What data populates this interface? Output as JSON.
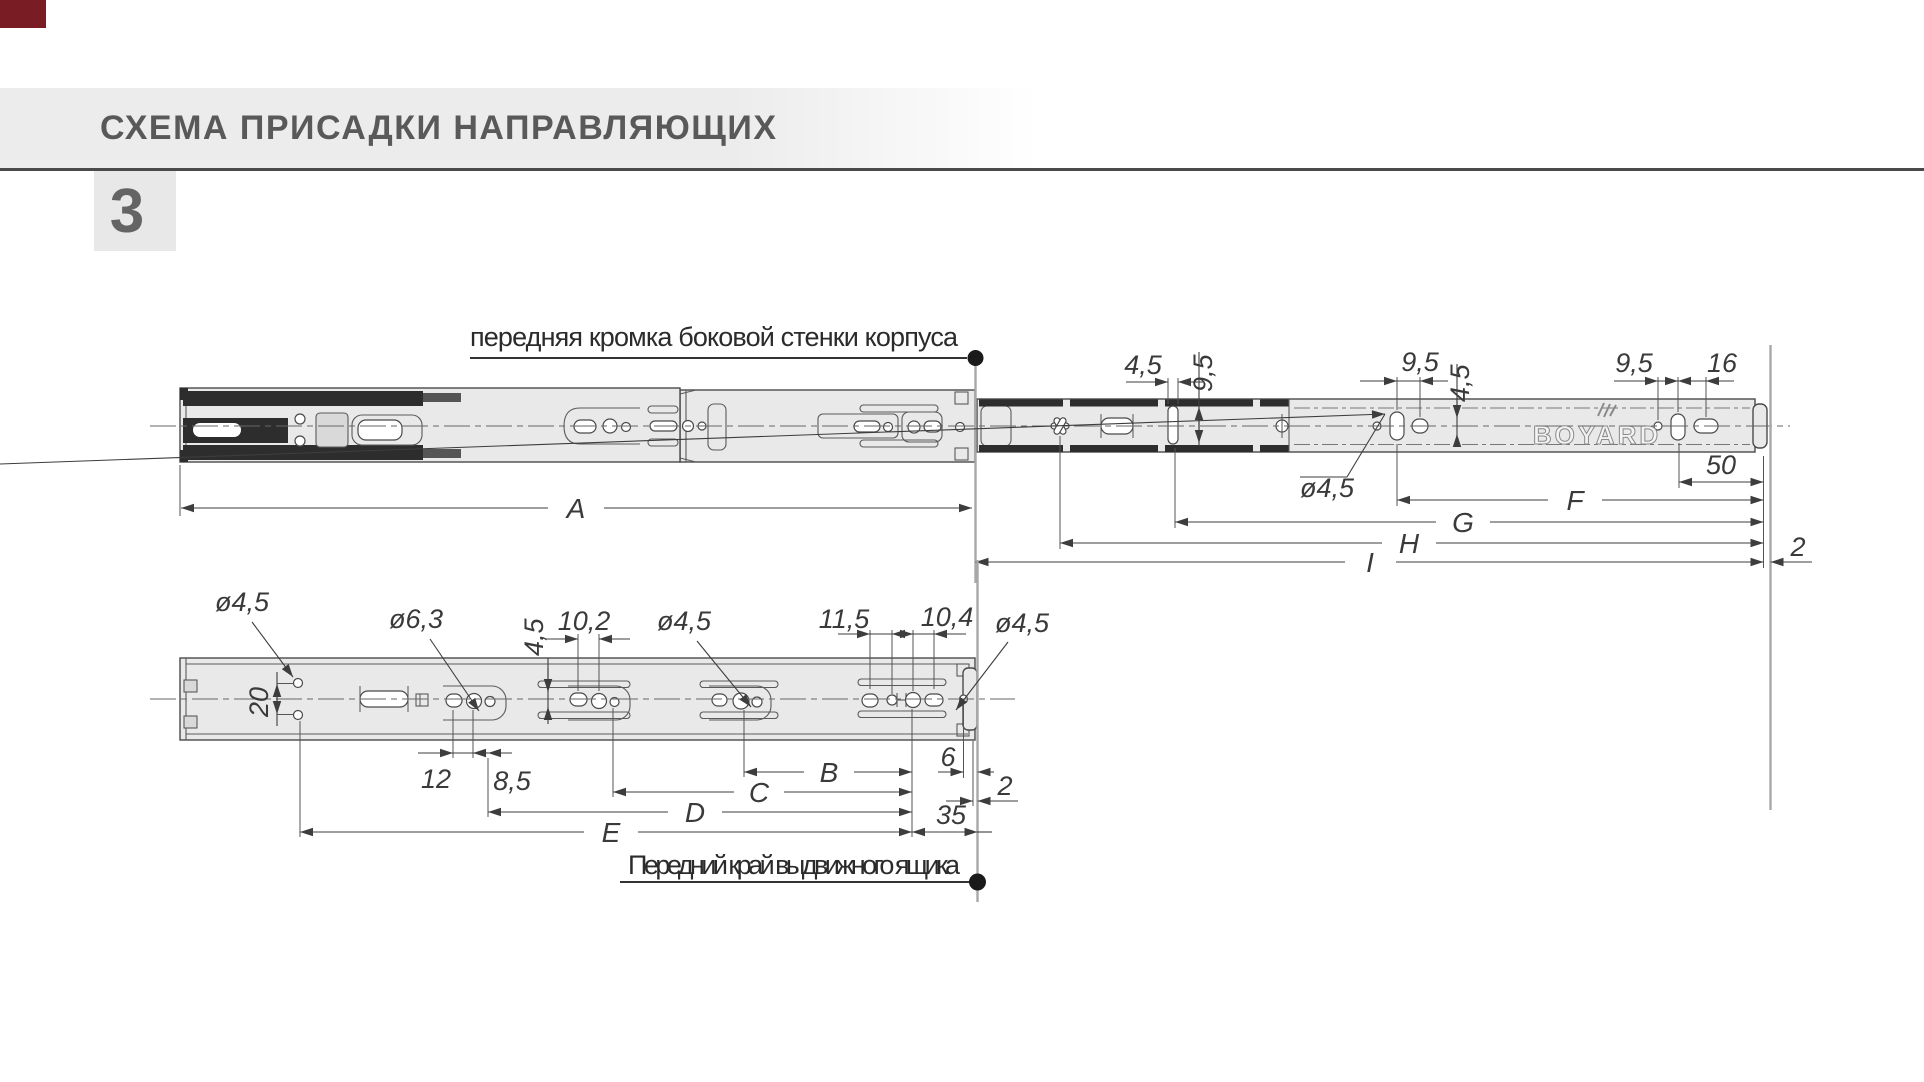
{
  "header": {
    "title": "СХЕМА ПРИСАДКИ НАПРАВЛЯЮЩИХ",
    "step_number": "3"
  },
  "colors": {
    "corner_mark": "#7a1c24",
    "band": "#ececec",
    "title_text": "#595959",
    "rule": "#4a4a4a",
    "rail_fill": "#e9e9e9",
    "outline": "#4a4a4a",
    "dim": "#3d3d3d",
    "reference_line": "#a8a8a8"
  },
  "top_view": {
    "edge_label": "передняя кромка боковой стенки корпуса",
    "brand": "BOYARD",
    "dims": {
      "slot_width": "4,5",
      "slot_height": "9,5",
      "mid_pitch": "9,5",
      "mid_offset": "4,5",
      "hole_dia": "ø4,5",
      "rear_pitch": "9,5",
      "rear_slot": "16",
      "rear_offset": "50",
      "back_gap": "2"
    },
    "letters": {
      "a": "A",
      "f": "F",
      "g": "G",
      "h": "H",
      "i": "I"
    }
  },
  "bottom_view": {
    "front_label": "Передний край выдвижного ящика",
    "dims": {
      "hole_dia_left": "ø4,5",
      "hole_pitch_vert": "20",
      "hole_dia_center": "ø6,3",
      "pitch_12": "12",
      "pitch_85": "8,5",
      "offset_45": "4,5",
      "pitch_102": "10,2",
      "hole_dia_mid": "ø4,5",
      "pitch_115": "11,5",
      "pitch_104": "10,4",
      "hole_dia_front": "ø4,5",
      "front_offset": "6",
      "front_gap": "2",
      "front_pitch": "35"
    },
    "letters": {
      "b": "B",
      "c": "C",
      "d": "D",
      "e": "E"
    }
  }
}
